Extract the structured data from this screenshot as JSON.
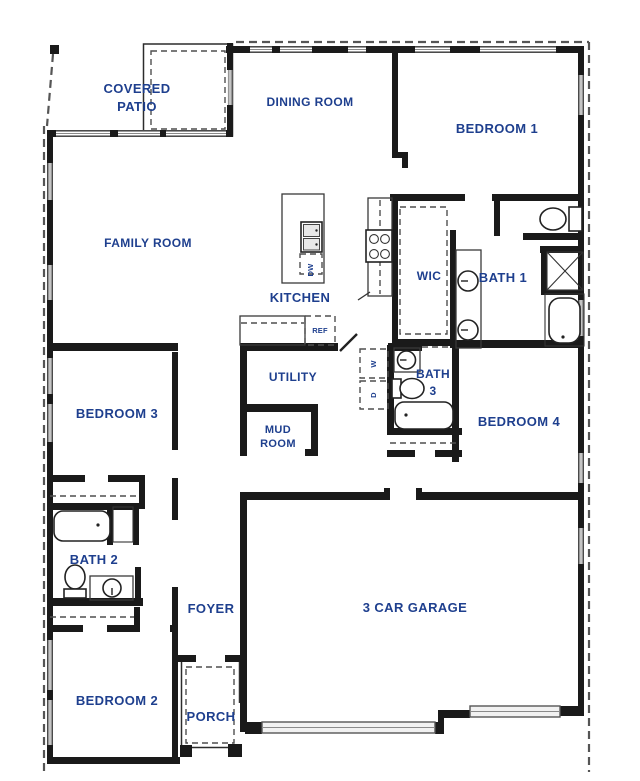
{
  "plan": {
    "title": "single-story house floor plan",
    "colors": {
      "wall": "#1a1a1a",
      "label": "#1e3f8e",
      "window_line": "#8a8a8a",
      "dashed": "#4f4f4f"
    },
    "rooms": {
      "covered_patio": {
        "line1": "COVERED",
        "line2": "PATIO"
      },
      "dining_room": {
        "label": "DINING ROOM"
      },
      "bedroom_1": {
        "label": "BEDROOM 1"
      },
      "family_room": {
        "label": "FAMILY ROOM"
      },
      "kitchen": {
        "label": "KITCHEN"
      },
      "wic": {
        "label": "WIC"
      },
      "bath_1": {
        "label": "BATH 1"
      },
      "utility": {
        "label": "UTILITY"
      },
      "bath_3": {
        "line1": "BATH",
        "line2": "3"
      },
      "mud_room": {
        "line1": "MUD",
        "line2": "ROOM"
      },
      "bedroom_3": {
        "label": "BEDROOM 3"
      },
      "bedroom_4": {
        "label": "BEDROOM 4"
      },
      "bath_2": {
        "label": "BATH 2"
      },
      "foyer": {
        "label": "FOYER"
      },
      "garage": {
        "label": "3 CAR GARAGE"
      },
      "bedroom_2": {
        "label": "BEDROOM 2"
      },
      "porch": {
        "label": "PORCH"
      }
    },
    "appliances": {
      "dishwasher": "DW",
      "refrigerator": "REF",
      "washer": "W",
      "dryer": "D"
    }
  }
}
